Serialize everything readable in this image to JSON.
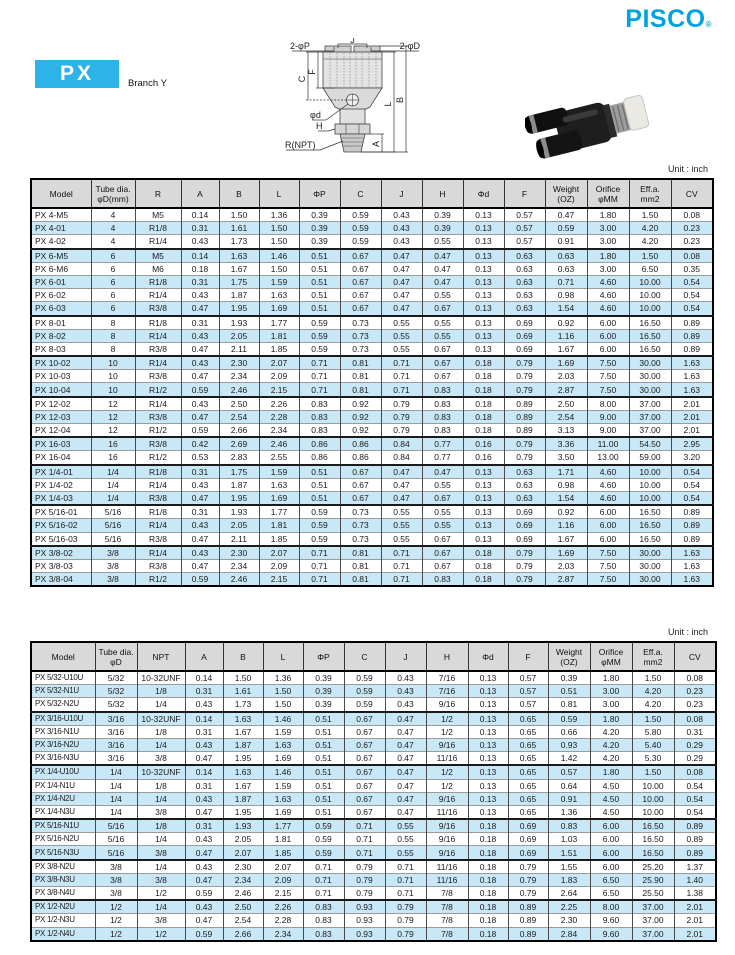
{
  "brand": {
    "logo": "PISCO",
    "registered": "®"
  },
  "header": {
    "series_code": "PX",
    "series_name": "Branch Y"
  },
  "diagram": {
    "labels": {
      "top_p": "2-φP",
      "top_j": "J",
      "top_d": "2-φD",
      "left_c": "C",
      "left_f": "F",
      "right_l": "L",
      "right_b": "B",
      "right_a": "A",
      "phi_d": "φd",
      "h": "H",
      "r_npt": "R(NPT)"
    }
  },
  "colors": {
    "brand_cyan": "#00a3df",
    "badge_cyan": "#2cb3e8",
    "row_highlight": "#c9e8f7",
    "header_gray": "#d9d9d9"
  },
  "tables": [
    {
      "unit": "Unit : inch",
      "columns": [
        "Model",
        "Tube dia.\nφD(mm)",
        "R",
        "A",
        "B",
        "L",
        "ΦP",
        "C",
        "J",
        "H",
        "Φd",
        "F",
        "Weight\n(OZ)",
        "Orifice\nφMM",
        "Eff.a.\nmm2",
        "CV"
      ],
      "rows": [
        [
          "PX 4-M5",
          "4",
          "M5",
          "0.14",
          "1.50",
          "1.36",
          "0.39",
          "0.59",
          "0.43",
          "0.39",
          "0.13",
          "0.57",
          "0.47",
          "1.80",
          "1.50",
          "0.08"
        ],
        [
          "PX 4-01",
          "4",
          "R1/8",
          "0.31",
          "1.61",
          "1.50",
          "0.39",
          "0.59",
          "0.43",
          "0.39",
          "0.13",
          "0.57",
          "0.59",
          "3.00",
          "4.20",
          "0.23"
        ],
        [
          "PX 4-02",
          "4",
          "R1/4",
          "0.43",
          "1.73",
          "1.50",
          "0.39",
          "0.59",
          "0.43",
          "0.55",
          "0.13",
          "0.57",
          "0.91",
          "3.00",
          "4.20",
          "0.23"
        ],
        [
          "PX 6-M5",
          "6",
          "M5",
          "0.14",
          "1.63",
          "1.46",
          "0.51",
          "0.67",
          "0.47",
          "0.47",
          "0.13",
          "0.63",
          "0.63",
          "1.80",
          "1.50",
          "0.08"
        ],
        [
          "PX 6-M6",
          "6",
          "M6",
          "0.18",
          "1.67",
          "1.50",
          "0.51",
          "0.67",
          "0.47",
          "0.47",
          "0.13",
          "0.63",
          "0.63",
          "3.00",
          "6.50",
          "0.35"
        ],
        [
          "PX 6-01",
          "6",
          "R1/8",
          "0.31",
          "1.75",
          "1.59",
          "0.51",
          "0.67",
          "0.47",
          "0.47",
          "0.13",
          "0.63",
          "0.71",
          "4.60",
          "10.00",
          "0.54"
        ],
        [
          "PX 6-02",
          "6",
          "R1/4",
          "0.43",
          "1.87",
          "1.63",
          "0.51",
          "0.67",
          "0.47",
          "0.55",
          "0.13",
          "0.63",
          "0.98",
          "4.60",
          "10.00",
          "0.54"
        ],
        [
          "PX 6-03",
          "6",
          "R3/8",
          "0.47",
          "1.95",
          "1.69",
          "0.51",
          "0.67",
          "0.47",
          "0.67",
          "0.13",
          "0.63",
          "1.54",
          "4.60",
          "10.00",
          "0.54"
        ],
        [
          "PX 8-01",
          "8",
          "R1/8",
          "0.31",
          "1.93",
          "1.77",
          "0.59",
          "0.73",
          "0.55",
          "0.55",
          "0.13",
          "0.69",
          "0.92",
          "6.00",
          "16.50",
          "0.89"
        ],
        [
          "PX 8-02",
          "8",
          "R1/4",
          "0.43",
          "2.05",
          "1.81",
          "0.59",
          "0.73",
          "0.55",
          "0.55",
          "0.13",
          "0.69",
          "1.16",
          "6.00",
          "16.50",
          "0.89"
        ],
        [
          "PX 8-03",
          "8",
          "R3/8",
          "0.47",
          "2.11",
          "1.85",
          "0.59",
          "0.73",
          "0.55",
          "0.67",
          "0.13",
          "0.69",
          "1.67",
          "6.00",
          "16.50",
          "0.89"
        ],
        [
          "PX 10-02",
          "10",
          "R1/4",
          "0.43",
          "2.30",
          "2.07",
          "0.71",
          "0.81",
          "0.71",
          "0.67",
          "0.18",
          "0.79",
          "1.69",
          "7.50",
          "30.00",
          "1.63"
        ],
        [
          "PX 10-03",
          "10",
          "R3/8",
          "0.47",
          "2.34",
          "2.09",
          "0.71",
          "0.81",
          "0.71",
          "0.67",
          "0.18",
          "0.79",
          "2.03",
          "7.50",
          "30.00",
          "1.63"
        ],
        [
          "PX 10-04",
          "10",
          "R1/2",
          "0.59",
          "2.46",
          "2.15",
          "0.71",
          "0.81",
          "0.71",
          "0.83",
          "0.18",
          "0.79",
          "2.87",
          "7.50",
          "30.00",
          "1.63"
        ],
        [
          "PX 12-02",
          "12",
          "R1/4",
          "0.43",
          "2.50",
          "2.26",
          "0.83",
          "0.92",
          "0.79",
          "0.83",
          "0.18",
          "0.89",
          "2.50",
          "8.00",
          "37.00",
          "2.01"
        ],
        [
          "PX 12-03",
          "12",
          "R3/8",
          "0.47",
          "2.54",
          "2.28",
          "0.83",
          "0.92",
          "0.79",
          "0.83",
          "0.18",
          "0.89",
          "2.54",
          "9.00",
          "37.00",
          "2.01"
        ],
        [
          "PX 12-04",
          "12",
          "R1/2",
          "0.59",
          "2.66",
          "2.34",
          "0.83",
          "0.92",
          "0.79",
          "0.83",
          "0.18",
          "0.89",
          "3.13",
          "9.00",
          "37.00",
          "2.01"
        ],
        [
          "PX 16-03",
          "16",
          "R3/8",
          "0.42",
          "2.69",
          "2.46",
          "0.86",
          "0.86",
          "0.84",
          "0.77",
          "0.16",
          "0.79",
          "3.36",
          "11.00",
          "54.50",
          "2.95"
        ],
        [
          "PX 16-04",
          "16",
          "R1/2",
          "0.53",
          "2.83",
          "2.55",
          "0.86",
          "0.86",
          "0.84",
          "0.77",
          "0.16",
          "0.79",
          "3.50",
          "13.00",
          "59.00",
          "3.20"
        ],
        [
          "PX 1/4-01",
          "1/4",
          "R1/8",
          "0.31",
          "1.75",
          "1.59",
          "0.51",
          "0.67",
          "0.47",
          "0.47",
          "0.13",
          "0.63",
          "1.71",
          "4.60",
          "10.00",
          "0.54"
        ],
        [
          "PX 1/4-02",
          "1/4",
          "R1/4",
          "0.43",
          "1.87",
          "1.63",
          "0.51",
          "0.67",
          "0.47",
          "0.55",
          "0.13",
          "0.63",
          "0.98",
          "4.60",
          "10.00",
          "0.54"
        ],
        [
          "PX 1/4-03",
          "1/4",
          "R3/8",
          "0.47",
          "1.95",
          "1.69",
          "0.51",
          "0.67",
          "0.47",
          "0.67",
          "0.13",
          "0.63",
          "1.54",
          "4.60",
          "10.00",
          "0.54"
        ],
        [
          "PX 5/16-01",
          "5/16",
          "R1/8",
          "0.31",
          "1.93",
          "1.77",
          "0.59",
          "0.73",
          "0.55",
          "0.55",
          "0.13",
          "0.69",
          "0.92",
          "6.00",
          "16.50",
          "0.89"
        ],
        [
          "PX 5/16-02",
          "5/16",
          "R1/4",
          "0.43",
          "2.05",
          "1.81",
          "0.59",
          "0.73",
          "0.55",
          "0.55",
          "0.13",
          "0.69",
          "1.16",
          "6.00",
          "16.50",
          "0.89"
        ],
        [
          "PX 5/16-03",
          "5/16",
          "R3/8",
          "0.47",
          "2.11",
          "1.85",
          "0.59",
          "0.73",
          "0.55",
          "0.67",
          "0.13",
          "0.69",
          "1.67",
          "6.00",
          "16.50",
          "0.89"
        ],
        [
          "PX 3/8-02",
          "3/8",
          "R1/4",
          "0.43",
          "2.30",
          "2.07",
          "0.71",
          "0.81",
          "0.71",
          "0.67",
          "0.18",
          "0.79",
          "1.69",
          "7.50",
          "30.00",
          "1.63"
        ],
        [
          "PX 3/8-03",
          "3/8",
          "R3/8",
          "0.47",
          "2.34",
          "2.09",
          "0.71",
          "0.81",
          "0.71",
          "0.67",
          "0.18",
          "0.79",
          "2.03",
          "7.50",
          "30.00",
          "1.63"
        ],
        [
          "PX 3/8-04",
          "3/8",
          "R1/2",
          "0.59",
          "2.46",
          "2.15",
          "0.71",
          "0.81",
          "0.71",
          "0.83",
          "0.18",
          "0.79",
          "2.87",
          "7.50",
          "30.00",
          "1.63"
        ]
      ]
    },
    {
      "unit": "Unit : inch",
      "columns": [
        "Model",
        "Tube dia.\nφD",
        "NPT",
        "A",
        "B",
        "L",
        "ΦP",
        "C",
        "J",
        "H",
        "Φd",
        "F",
        "Weight\n(OZ)",
        "Orifice\nφMM",
        "Eff.a.\nmm2",
        "CV"
      ],
      "rows": [
        [
          "PX 5/32-U10U",
          "5/32",
          "10-32UNF",
          "0.14",
          "1.50",
          "1.36",
          "0.39",
          "0.59",
          "0.43",
          "7/16",
          "0.13",
          "0.57",
          "0.39",
          "1.80",
          "1.50",
          "0.08"
        ],
        [
          "PX 5/32-N1U",
          "5/32",
          "1/8",
          "0.31",
          "1.61",
          "1.50",
          "0.39",
          "0.59",
          "0.43",
          "7/16",
          "0.13",
          "0.57",
          "0.51",
          "3.00",
          "4.20",
          "0.23"
        ],
        [
          "PX 5/32-N2U",
          "5/32",
          "1/4",
          "0.43",
          "1.73",
          "1.50",
          "0.39",
          "0.59",
          "0.43",
          "9/16",
          "0.13",
          "0.57",
          "0.81",
          "3.00",
          "4.20",
          "0.23"
        ],
        [
          "PX 3/16-U10U",
          "3/16",
          "10-32UNF",
          "0.14",
          "1.63",
          "1.46",
          "0.51",
          "0.67",
          "0.47",
          "1/2",
          "0.13",
          "0.65",
          "0.59",
          "1.80",
          "1.50",
          "0.08"
        ],
        [
          "PX 3/16-N1U",
          "3/16",
          "1/8",
          "0.31",
          "1.67",
          "1.59",
          "0.51",
          "0.67",
          "0.47",
          "1/2",
          "0.13",
          "0.65",
          "0.66",
          "4.20",
          "5.80",
          "0.31"
        ],
        [
          "PX 3/16-N2U",
          "3/16",
          "1/4",
          "0.43",
          "1.87",
          "1.63",
          "0.51",
          "0.67",
          "0.47",
          "9/16",
          "0.13",
          "0.65",
          "0.93",
          "4.20",
          "5.40",
          "0.29"
        ],
        [
          "PX 3/16-N3U",
          "3/16",
          "3/8",
          "0.47",
          "1.95",
          "1.69",
          "0.51",
          "0.67",
          "0.47",
          "11/16",
          "0.13",
          "0.65",
          "1.42",
          "4.20",
          "5.30",
          "0.29"
        ],
        [
          "PX 1/4-U10U",
          "1/4",
          "10-32UNF",
          "0.14",
          "1.63",
          "1.46",
          "0.51",
          "0.67",
          "0.47",
          "1/2",
          "0.13",
          "0.65",
          "0.57",
          "1.80",
          "1.50",
          "0.08"
        ],
        [
          "PX 1/4-N1U",
          "1/4",
          "1/8",
          "0.31",
          "1.67",
          "1.59",
          "0.51",
          "0.67",
          "0.47",
          "1/2",
          "0.13",
          "0.65",
          "0.64",
          "4.50",
          "10.00",
          "0.54"
        ],
        [
          "PX 1/4-N2U",
          "1/4",
          "1/4",
          "0.43",
          "1.87",
          "1.63",
          "0.51",
          "0.67",
          "0.47",
          "9/16",
          "0.13",
          "0.65",
          "0.91",
          "4.50",
          "10.00",
          "0.54"
        ],
        [
          "PX 1/4-N3U",
          "1/4",
          "3/8",
          "0.47",
          "1.95",
          "1.69",
          "0.51",
          "0.67",
          "0.47",
          "11/16",
          "0.13",
          "0.65",
          "1.36",
          "4.50",
          "10.00",
          "0.54"
        ],
        [
          "PX 5/16-N1U",
          "5/16",
          "1/8",
          "0.31",
          "1.93",
          "1.77",
          "0.59",
          "0.71",
          "0.55",
          "9/16",
          "0.18",
          "0.69",
          "0.83",
          "6.00",
          "16.50",
          "0.89"
        ],
        [
          "PX 5/16-N2U",
          "5/16",
          "1/4",
          "0.43",
          "2.05",
          "1.81",
          "0.59",
          "0.71",
          "0.55",
          "9/16",
          "0.18",
          "0.69",
          "1.03",
          "6.00",
          "16.50",
          "0.89"
        ],
        [
          "PX 5/16-N3U",
          "5/16",
          "3/8",
          "0.47",
          "2.07",
          "1.85",
          "0.59",
          "0.71",
          "0.55",
          "9/16",
          "0.18",
          "0.69",
          "1.51",
          "6.00",
          "16.50",
          "0.89"
        ],
        [
          "PX 3/8-N2U",
          "3/8",
          "1/4",
          "0.43",
          "2.30",
          "2.07",
          "0.71",
          "0.79",
          "0.71",
          "11/16",
          "0.18",
          "0.79",
          "1.55",
          "6.00",
          "25.20",
          "1.37"
        ],
        [
          "PX 3/8-N3U",
          "3/8",
          "3/8",
          "0.47",
          "2.34",
          "2.09",
          "0.71",
          "0.79",
          "0.71",
          "11/16",
          "0.18",
          "0.79",
          "1.83",
          "6.50",
          "25.90",
          "1.40"
        ],
        [
          "PX 3/8-N4U",
          "3/8",
          "1/2",
          "0.59",
          "2.46",
          "2.15",
          "0.71",
          "0.79",
          "0.71",
          "7/8",
          "0.18",
          "0.79",
          "2.64",
          "6.50",
          "25.50",
          "1.38"
        ],
        [
          "PX 1/2-N2U",
          "1/2",
          "1/4",
          "0.43",
          "2.50",
          "2.26",
          "0.83",
          "0.93",
          "0.79",
          "7/8",
          "0.18",
          "0.89",
          "2.25",
          "8.00",
          "37.00",
          "2.01"
        ],
        [
          "PX 1/2-N3U",
          "1/2",
          "3/8",
          "0.47",
          "2.54",
          "2.28",
          "0.83",
          "0.93",
          "0.79",
          "7/8",
          "0.18",
          "0.89",
          "2.30",
          "9.60",
          "37.00",
          "2.01"
        ],
        [
          "PX 1/2-N4U",
          "1/2",
          "1/2",
          "0.59",
          "2.66",
          "2.34",
          "0.83",
          "0.93",
          "0.79",
          "7/8",
          "0.18",
          "0.89",
          "2.84",
          "9.60",
          "37.00",
          "2.01"
        ]
      ]
    }
  ]
}
